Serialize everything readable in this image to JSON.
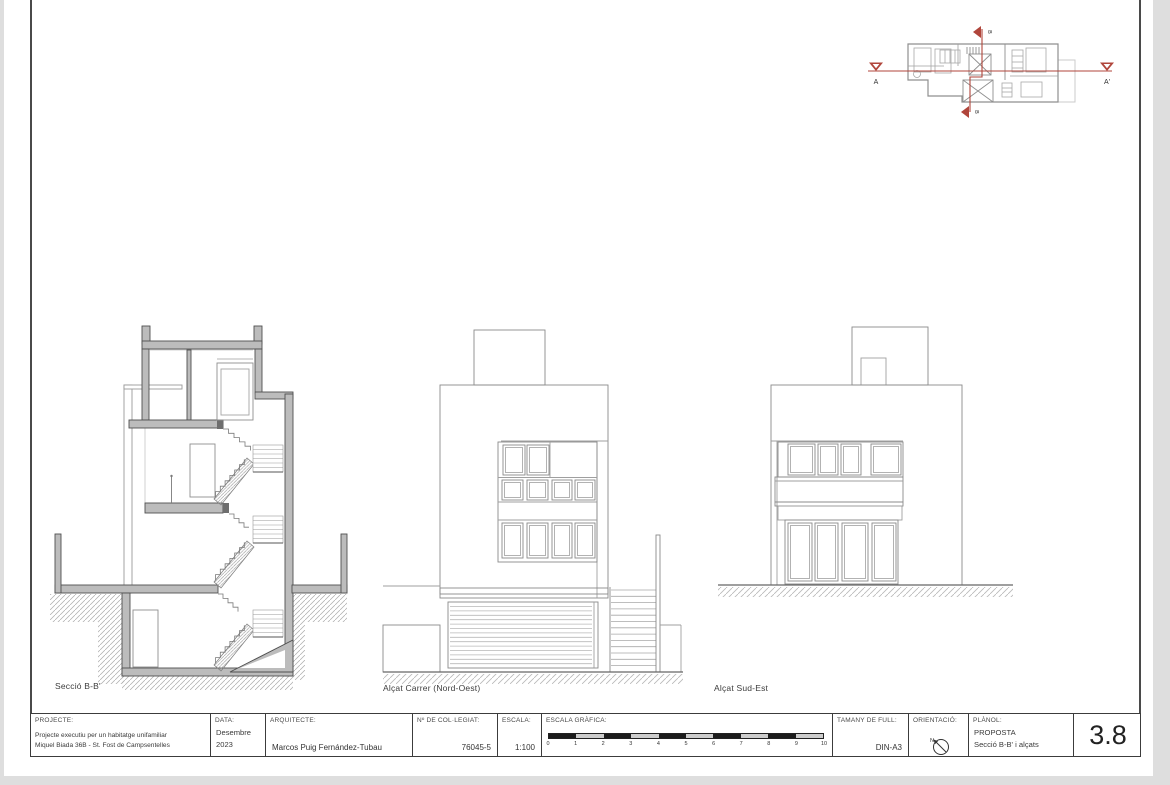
{
  "colors": {
    "accent_red": "#b0453b",
    "wall_gray": "#bcbcbc",
    "line_gray": "#8a8a8a"
  },
  "key_plan": {
    "marker_a_start": "A",
    "marker_a_end": "A'",
    "marker_b_top": "B",
    "marker_b_bottom": "B"
  },
  "drawings": {
    "section": {
      "label": "Secció B-B'"
    },
    "elevation_street": {
      "label": "Alçat Carrer (Nord-Oest)"
    },
    "elevation_se": {
      "label": "Alçat Sud-Est"
    }
  },
  "title_block": {
    "projecte": {
      "label": "PROJECTE:",
      "line1": "Projecte executiu per un habitatge unifamiliar",
      "line2": "Miquel Biada 36B - St. Fost de Campsentelles"
    },
    "data": {
      "label": "DATA:",
      "line1": "Desembre",
      "line2": "2023"
    },
    "arquitecte": {
      "label": "ARQUITECTE:",
      "value": "Marcos Puig Fernández-Tubau"
    },
    "collegiat": {
      "label": "Nº DE COL·LEGIAT:",
      "value": "76045-5"
    },
    "escala": {
      "label": "ESCALA:",
      "value": "1:100"
    },
    "escala_grafica": {
      "label": "ESCALA GRÀFICA:",
      "ticks": [
        "0",
        "1",
        "2",
        "3",
        "4",
        "5",
        "6",
        "7",
        "8",
        "9",
        "10"
      ]
    },
    "tamany": {
      "label": "TAMANY DE FULL:",
      "value": "DIN-A3"
    },
    "orientacio": {
      "label": "ORIENTACIÓ:",
      "north": "N"
    },
    "planol": {
      "label": "PLÀNOL:",
      "line1": "PROPOSTA",
      "line2": "Secció B-B' i alçats"
    },
    "sheet_number": "3.8"
  }
}
